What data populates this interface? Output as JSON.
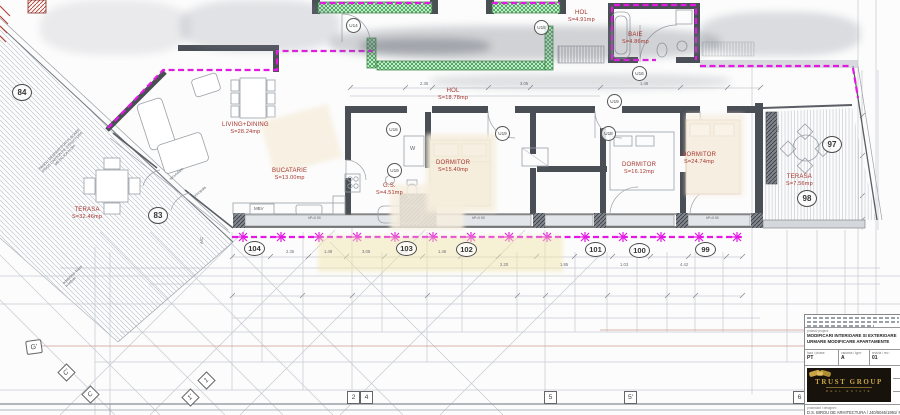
{
  "colors": {
    "wall_green": "#2fa14a",
    "modification_magenta": "#e318e3",
    "label_red": "#a5342c",
    "wall_dark": "#4a4e55",
    "logo_gold": "#c9a545",
    "logo_bg": "#17120b"
  },
  "rooms": [
    {
      "name": "TERASA",
      "area": "S=32.46mp"
    },
    {
      "name": "LIVING+DINING",
      "area": "S=28.24mp"
    },
    {
      "name": "BUCATARIE",
      "area": "S=13.00mp"
    },
    {
      "name": "G.S.",
      "area": "S=4.51mp"
    },
    {
      "name": "HOL",
      "area": "S=18.78mp"
    },
    {
      "name": "HOL",
      "area": "S=4.91mp"
    },
    {
      "name": "BAIE",
      "area": "S=4.86mp"
    },
    {
      "name": "DORMITOR",
      "area": "S=15.40mp"
    },
    {
      "name": "DORMITOR",
      "area": "S=16.12mp"
    },
    {
      "name": "DORMITOR",
      "area": "S=24.74mp"
    },
    {
      "name": "TERASA",
      "area": "S=7.56mp"
    }
  ],
  "position_markers": [
    "84",
    "83",
    "104",
    "103",
    "102",
    "101",
    "100",
    "99",
    "97",
    "98"
  ],
  "door_tags": [
    "U14",
    "U15",
    "U16",
    "U19",
    "U16",
    "U19",
    "U19",
    "U18"
  ],
  "grid_axes": {
    "diamonds": [
      "G'",
      "C'",
      "C",
      "1",
      "1'"
    ],
    "squares": [
      "2",
      "4",
      "5",
      "5'",
      "6"
    ]
  },
  "annotations": {
    "ac": "A/C",
    "wardrobe": "W",
    "mbv": "MBV",
    "door_secondary": "secundara",
    "door_main": "principala",
    "partition_l1": "PANOU DESPARTITOR PLACARE",
    "partition_l2": "IPSOS CARTON PE STRUCTURA",
    "partition_l3": "METALICA h=3m",
    "depth_l1": "adancime 40cm",
    "depth_l2": "h=40cm",
    "window_height": "hP=0.90"
  },
  "dimensions": [
    "1.20",
    "2.35",
    "1.48",
    "3.05",
    "1.35",
    "1.46",
    "2.20",
    "1.85",
    "1.03",
    "4.42"
  ],
  "title_block": {
    "project_label": "proiect/ project:",
    "project_line1": "MODIFICARI INTERIOARE SI EXTERIOARE",
    "project_line2": "URMARE MODIFICARE APARTAMENTE",
    "fields": [
      {
        "label": "faza / phase:",
        "value": "PT"
      },
      {
        "label": "varianta / type:",
        "value": "A"
      },
      {
        "label": "revizia / rev.:",
        "value": "01"
      }
    ],
    "logo_name": "TRUST GROUP",
    "logo_subtitle": "REAL ESTATE",
    "designer_label": "proiectant / designer:",
    "designer_value": "D.S. BIROU DE ARHITECTURA / J40/5046/1991/ RO36"
  }
}
